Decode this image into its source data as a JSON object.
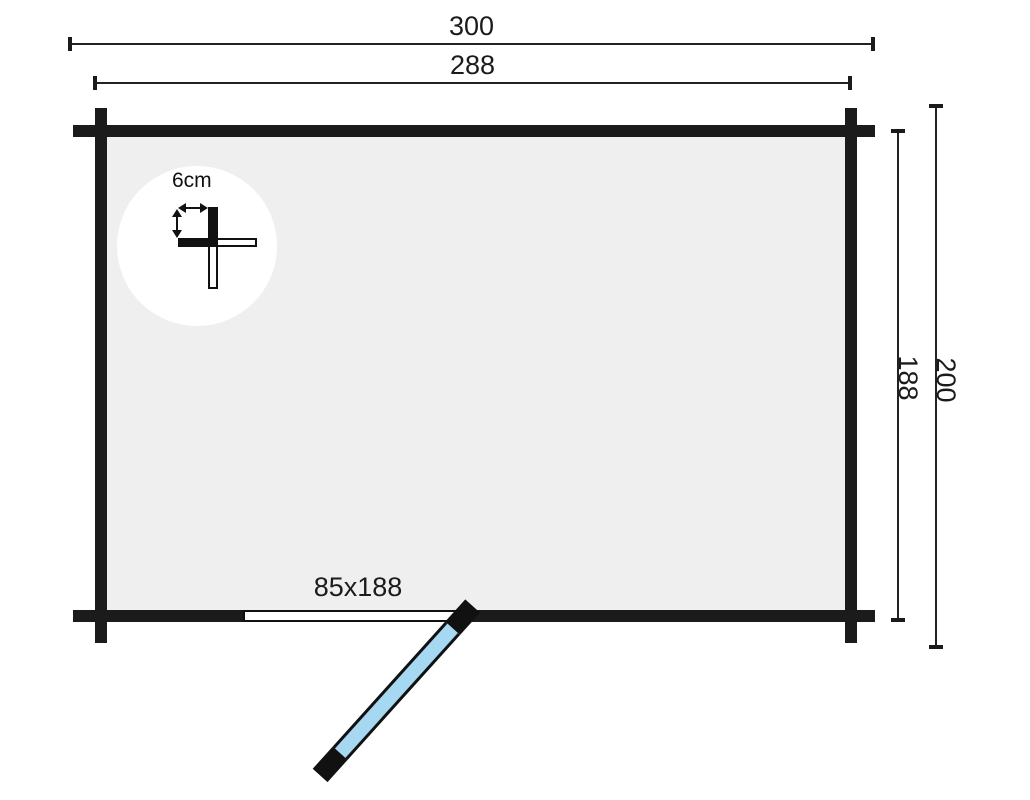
{
  "labels": {
    "overall_width": "300",
    "frame_width": "288",
    "overall_depth": "200",
    "frame_depth": "188",
    "door_size": "85x188",
    "wall_thickness": "6cm"
  },
  "colors": {
    "background": "#ffffff",
    "wall": "#1b1b1b",
    "floor": "#efefef",
    "door_panel": "#a7d8f2",
    "dimension_line": "#222222"
  }
}
